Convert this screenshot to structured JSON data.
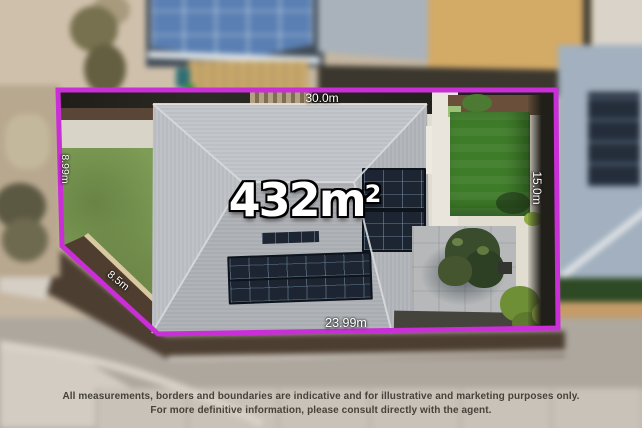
{
  "overlay": {
    "area": {
      "value": "432m",
      "superscript": "2"
    },
    "boundary_color": "#ca2ed6",
    "label_color": "#ffffff",
    "measurements": {
      "top": "30.0m",
      "right": "15.0m",
      "bottom": "23.99m",
      "left": "8.99m",
      "diagonal": "8.5m"
    }
  },
  "disclaimer": {
    "line1": "All measurements, borders and boundaries are indicative and for illustrative and marketing purposes only.",
    "line2": "For more definitive information, please consult directly with the agent."
  }
}
